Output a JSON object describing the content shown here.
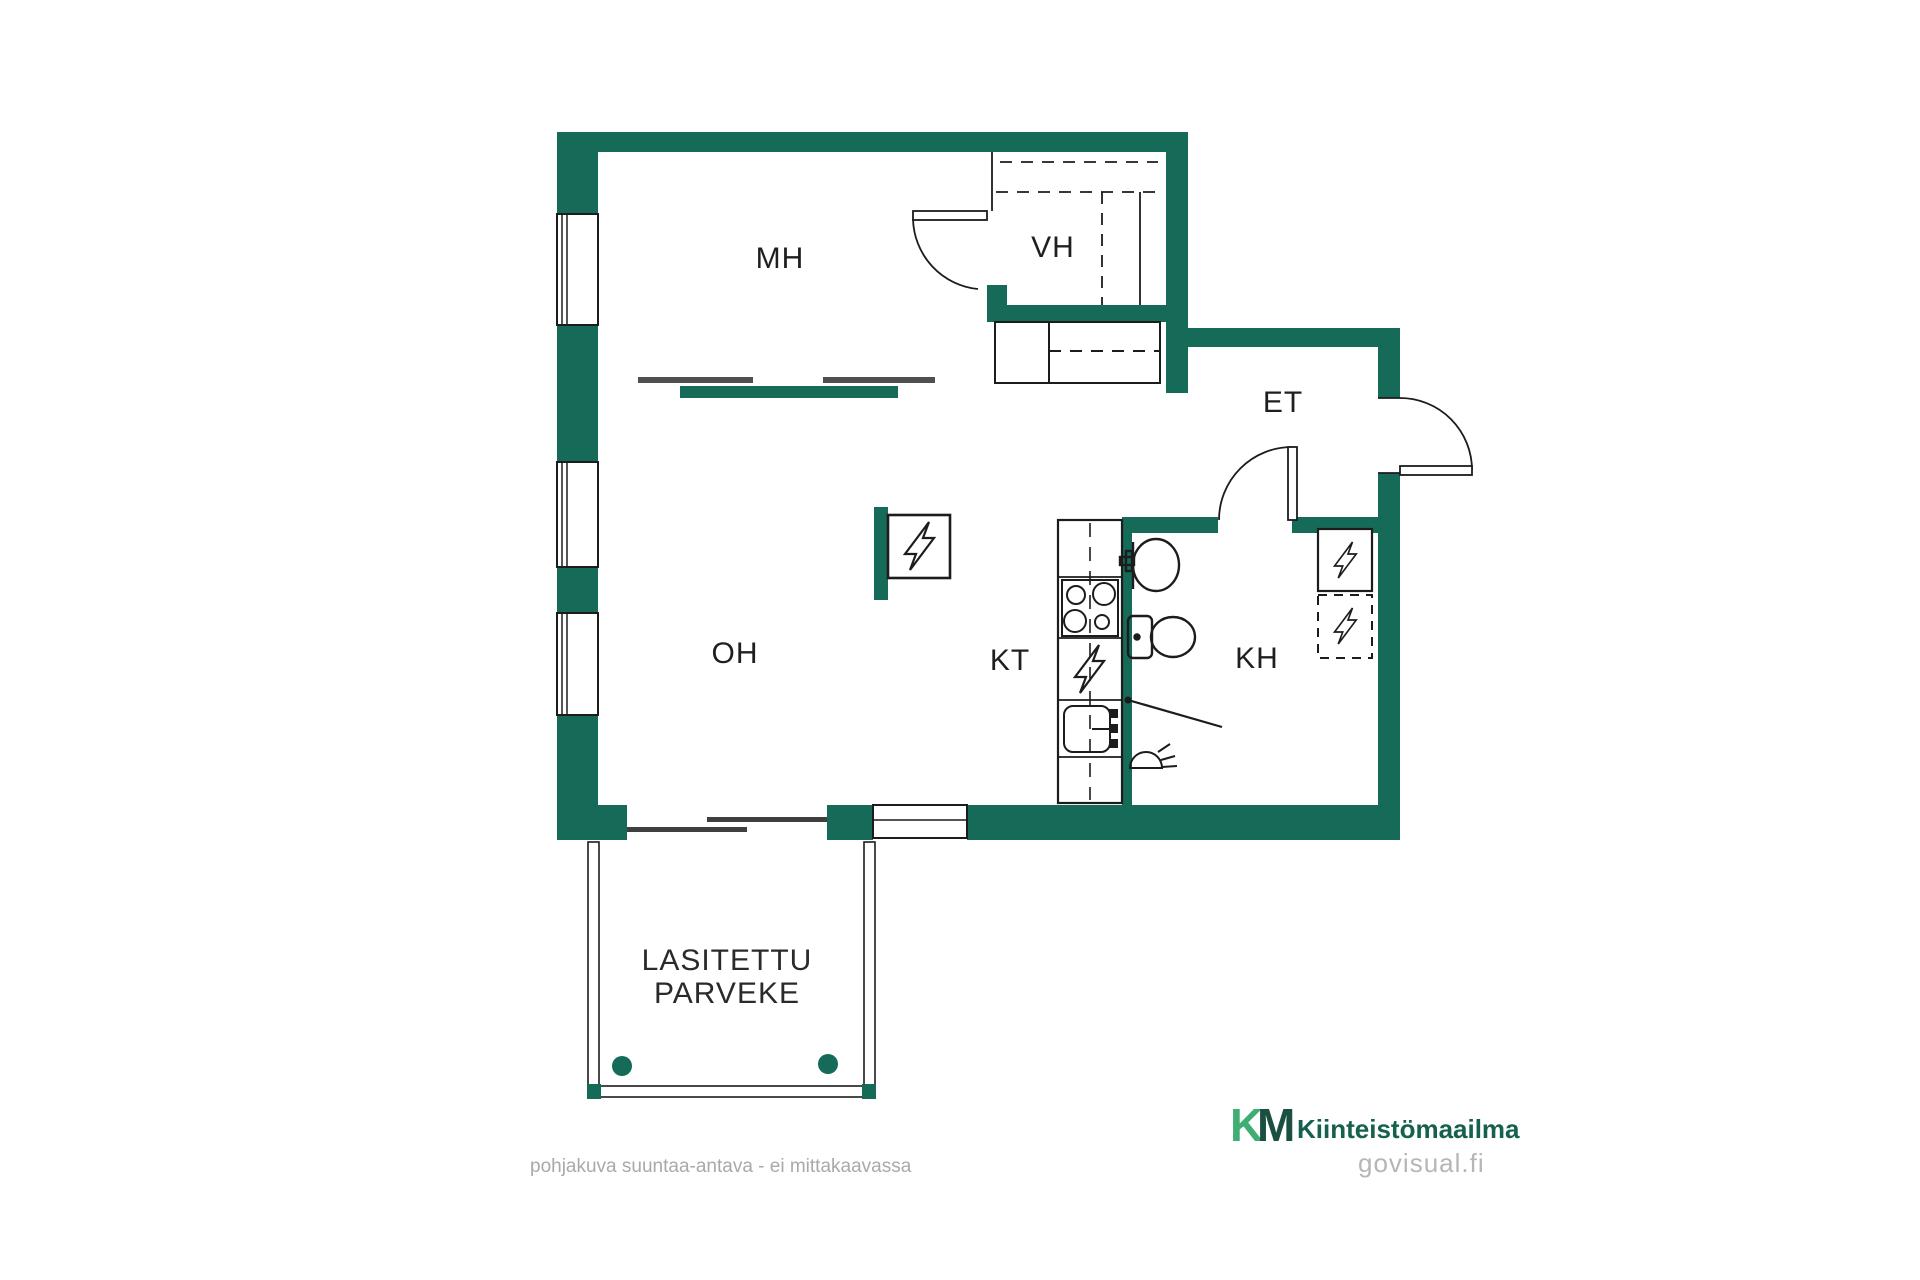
{
  "colors": {
    "wall": "#156a58",
    "line": "#1c1c1c",
    "slider_gray": "#4f4f4f",
    "label": "#1f1f1f",
    "muted_gray": "#a9a9a9",
    "logo_k_green": "#3fae73",
    "logo_m_green": "#1b4f41",
    "logo_text_green": "#15604e",
    "watermark_gray": "#b6b6b6"
  },
  "rooms": {
    "mh": "MH",
    "vh": "VH",
    "et": "ET",
    "oh": "OH",
    "kt": "KT",
    "kh": "KH"
  },
  "balcony": {
    "line1": "LASITETTU",
    "line2": "PARVEKE"
  },
  "footer": {
    "disclaimer": "pohjakuva suuntaa-antava - ei mittakaavassa"
  },
  "brand": {
    "k": "K",
    "m": "M",
    "name": "Kiinteistömaailma",
    "watermark": "govisual.fi"
  }
}
